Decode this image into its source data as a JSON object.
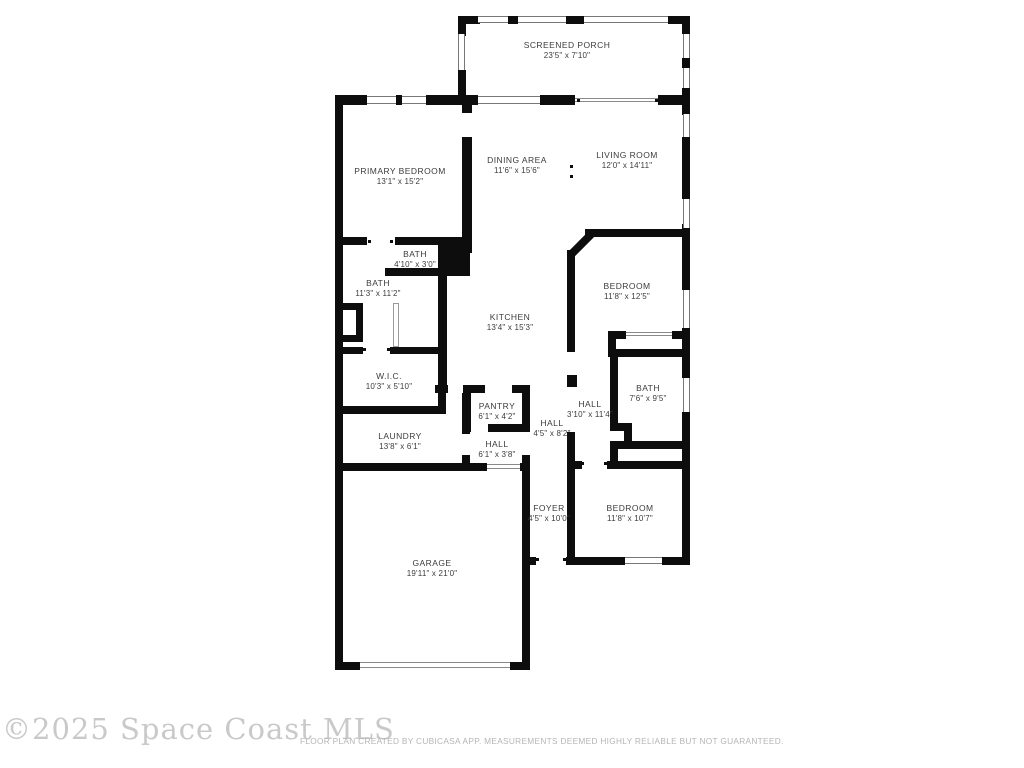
{
  "footer": {
    "watermark": "©2025 Space Coast MLS",
    "disclaimer": "FLOOR PLAN CREATED BY CUBICASA APP. MEASUREMENTS DEEMED HIGHLY RELIABLE BUT NOT GUARANTEED."
  },
  "colors": {
    "wall": "#0d0d0d",
    "label_text": "#3c3c3c",
    "window_line": "#777777",
    "watermark": "#c9c9c9",
    "disclaimer": "#b5b5b5"
  },
  "rooms": [
    {
      "id": "screened-porch",
      "name": "SCREENED PORCH",
      "dims": "23'5\" x 7'10\"",
      "cx": 567,
      "cy": 51
    },
    {
      "id": "primary-bedroom",
      "name": "PRIMARY BEDROOM",
      "dims": "13'1\" x 15'2\"",
      "cx": 400,
      "cy": 177
    },
    {
      "id": "dining-area",
      "name": "DINING AREA",
      "dims": "11'6\" x 15'6\"",
      "cx": 517,
      "cy": 166
    },
    {
      "id": "living-room",
      "name": "LIVING ROOM",
      "dims": "12'0\" x 14'11\"",
      "cx": 627,
      "cy": 161
    },
    {
      "id": "bath-powder",
      "name": "BATH",
      "dims": "4'10\" x 3'0\"",
      "cx": 415,
      "cy": 260
    },
    {
      "id": "bath-primary",
      "name": "BATH",
      "dims": "11'3\" x 11'2\"",
      "cx": 378,
      "cy": 289
    },
    {
      "id": "kitchen",
      "name": "KITCHEN",
      "dims": "13'4\" x 15'3\"",
      "cx": 510,
      "cy": 323
    },
    {
      "id": "bedroom-1",
      "name": "BEDROOM",
      "dims": "11'8\" x 12'5\"",
      "cx": 627,
      "cy": 292
    },
    {
      "id": "wic",
      "name": "W.I.C.",
      "dims": "10'3\" x 5'10\"",
      "cx": 389,
      "cy": 382
    },
    {
      "id": "pantry",
      "name": "PANTRY",
      "dims": "6'1\" x 4'2\"",
      "cx": 497,
      "cy": 412
    },
    {
      "id": "hall-center",
      "name": "HALL",
      "dims": "4'5\" x 8'2\"",
      "cx": 552,
      "cy": 429
    },
    {
      "id": "hall-right",
      "name": "HALL",
      "dims": "3'10\" x 11'4\"",
      "cx": 590,
      "cy": 410
    },
    {
      "id": "bath-2",
      "name": "BATH",
      "dims": "7'6\" x 9'5\"",
      "cx": 648,
      "cy": 394
    },
    {
      "id": "laundry",
      "name": "LAUNDRY",
      "dims": "13'8\" x 6'1\"",
      "cx": 400,
      "cy": 442
    },
    {
      "id": "hall-lower",
      "name": "HALL",
      "dims": "6'1\" x 3'8\"",
      "cx": 497,
      "cy": 450
    },
    {
      "id": "foyer",
      "name": "FOYER",
      "dims": "4'5\" x 10'0\"",
      "cx": 549,
      "cy": 514
    },
    {
      "id": "bedroom-2",
      "name": "BEDROOM",
      "dims": "11'8\" x 10'7\"",
      "cx": 630,
      "cy": 514
    },
    {
      "id": "garage",
      "name": "GARAGE",
      "dims": "19'11\" x 21'0\"",
      "cx": 432,
      "cy": 569
    }
  ]
}
